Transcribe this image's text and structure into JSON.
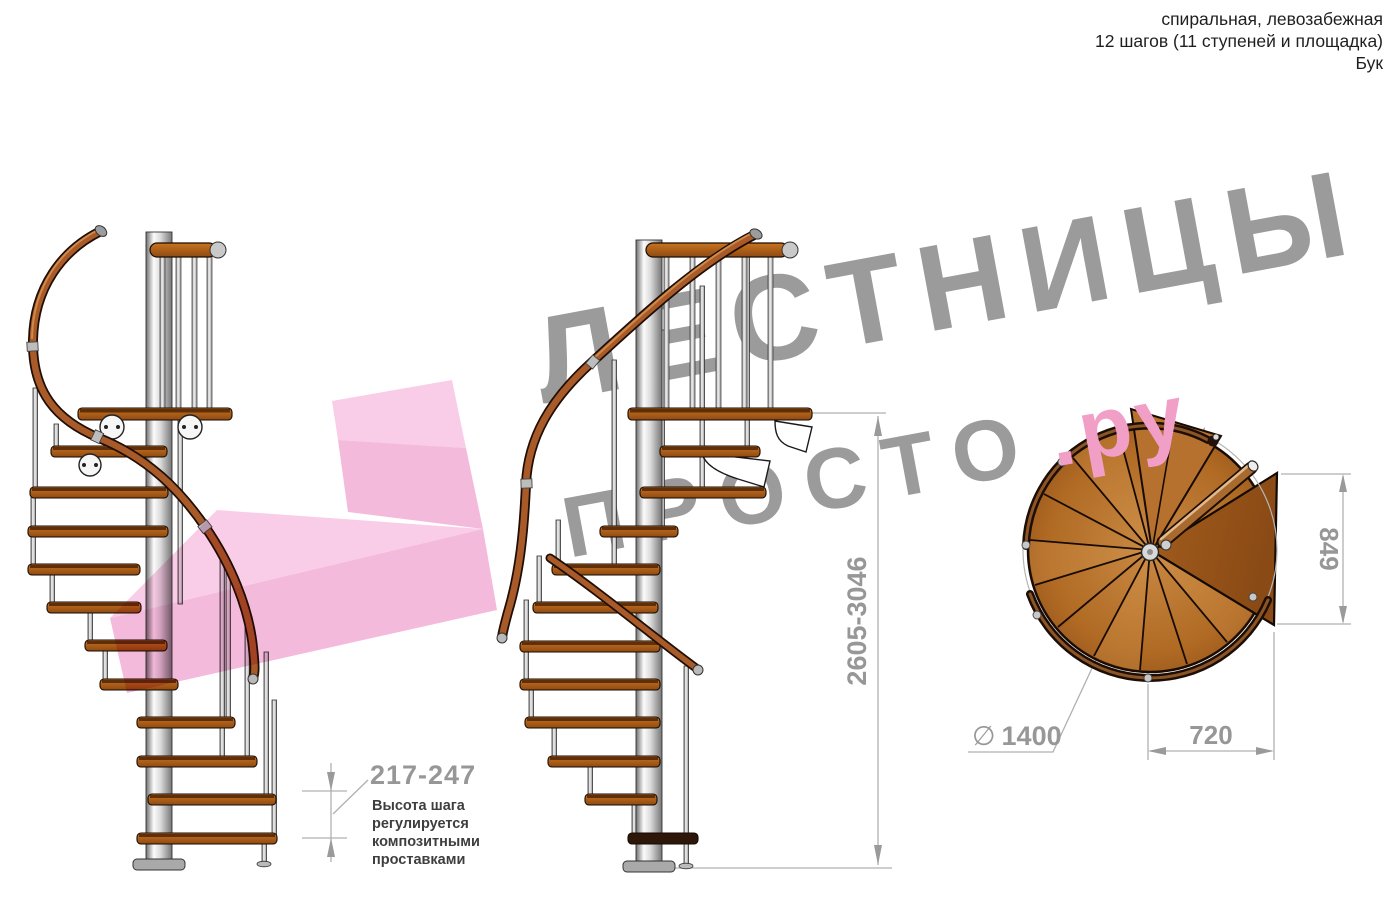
{
  "header": {
    "lines": [
      "спиральная, левозабежная",
      "12 шагов (11 ступеней и площадка)",
      "Бук"
    ]
  },
  "watermark": {
    "brand_top": "ЛЕСТНИЦЫ",
    "brand_bottom_gray": "ПРОСТО",
    "brand_bottom_pink": ".ру"
  },
  "dimensions": {
    "step_height": "217-247",
    "step_height_note_lines": [
      "Высота шага",
      "регулируется",
      "композитными",
      "проставками"
    ],
    "total_height": "2605-3046",
    "landing_depth": "849",
    "landing_width": "720",
    "diameter_symbol": "∅",
    "diameter_value": "1400"
  },
  "legend": {
    "views": [
      "side view A",
      "side view B",
      "top plan view"
    ]
  },
  "colors": {
    "wood": "#b0651f",
    "wood_dark": "#3a1d08",
    "pole_metal": "#d5d5d5",
    "dimension_gray": "#979797",
    "watermark_gray": "#9b9b9b",
    "accent_pink": "#f19fc7",
    "logo_pink_light": "#f8c8e4",
    "logo_pink_mid": "#f3b2d8"
  }
}
